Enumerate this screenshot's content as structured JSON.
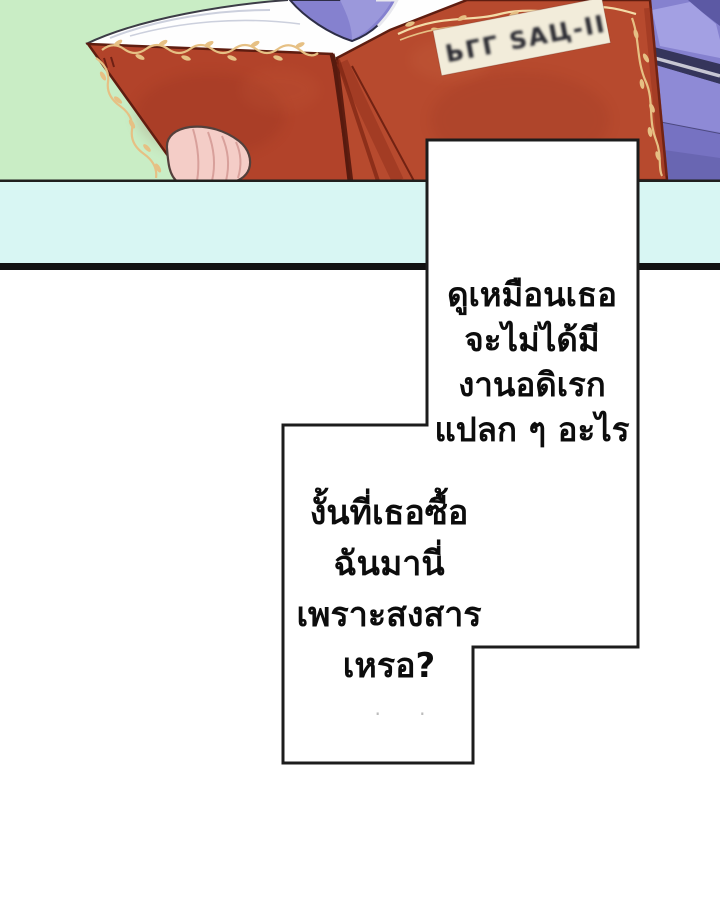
{
  "page": {
    "bubbles": [
      {
        "lines": [
          "ดูเหมือนเธอ",
          "จะไม่ได้มี",
          "งานอดิเรก",
          "แปลก ๆ อะไร"
        ]
      },
      {
        "lines": [
          "งั้นที่เธอซื้อ",
          "ฉันมานี่",
          "เพราะสงสาร",
          "เหรอ?"
        ]
      }
    ],
    "faint_marks": "· ·"
  },
  "book": {
    "label_glyphs": "ЬГГ ЅАЦ-ІІ"
  },
  "colors": {
    "background_green": "#c9edc5",
    "table_cyan": "#d8f6f3",
    "table_edge_line": "#20201e",
    "panel_border_black": "#111111",
    "book_red_left": "#b2432a",
    "book_red_right": "#b74a2e",
    "book_red_dark": "#8c2c18",
    "book_outline": "#5f1d10",
    "gold_ornament": "#e6c084",
    "gold_light": "#f3dca8",
    "label_bg": "#f2ecda",
    "label_ink": "#2b2b30",
    "pages_white": "#fefefe",
    "page_shade": "#ccd0dd",
    "hand_skin": "#f4cdc7",
    "hand_fold": "#d8a09b",
    "cloth_periwinkle": "#8581cf",
    "cloth_light": "#a3a0e3",
    "cloth_dark": "#6b67b8",
    "cloth_navy": "#35355b",
    "cloth_stripe": "#c7c7d3",
    "bubble_fill": "#ffffff",
    "bubble_border": "#1c1c1c",
    "text_color": "#0c0c0c"
  }
}
